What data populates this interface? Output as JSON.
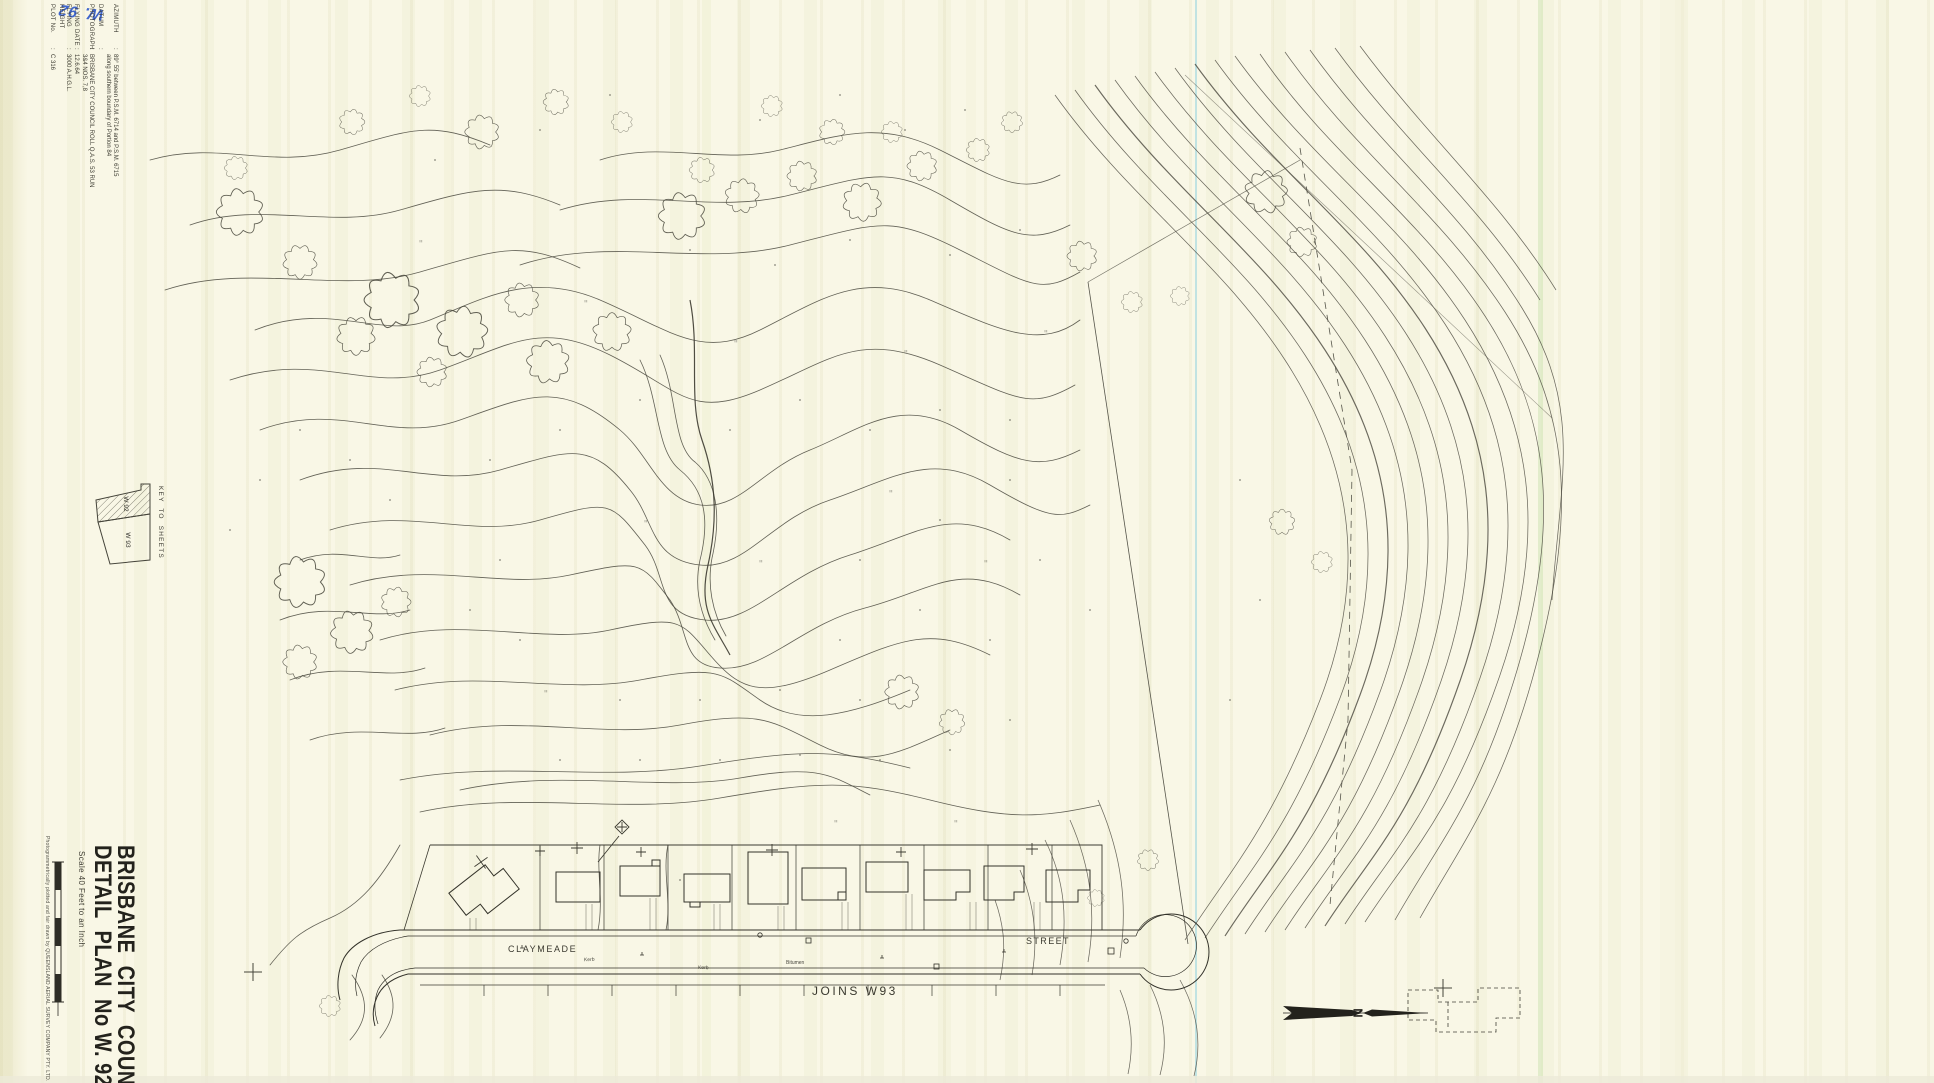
{
  "sheet": {
    "handwritten_note": "W. 92",
    "metadata": {
      "rows": [
        {
          "label": "AZIMUTH",
          "value": "89° 55' between P.S.M. 6714 and P.S.M. 6715 along southern boundary of Portion 84"
        },
        {
          "label": "DATUM",
          "value": ""
        },
        {
          "label": "PHOTOGRAPH",
          "value": "BRISBANE CITY COUNCIL  ROLL Q.A.S. 53 RUN 3&4 NOS. 7,8"
        },
        {
          "label": "FLYING DATE",
          "value": "12.6.64"
        },
        {
          "label": "FLYING HEIGHT",
          "value": "3000  A.H.G.L."
        },
        {
          "label": "PLOT No.",
          "value": "C 316"
        }
      ]
    },
    "key_to_sheets": {
      "label": "KEY  TO  SHEETS",
      "current_sheet": "W 92",
      "adjacent_sheet": "W 93"
    },
    "title_block": {
      "org": "BRISBANE  CITY  COUNCIL",
      "plan": "DETAIL  PLAN  No W. 92",
      "scale": "Scale 40 Feet to an Inch",
      "credit": "Photogrammetrically plotted and fair drawn by  QUEENSLAND AERIAL SURVEY COMPANY PTY. LTD."
    },
    "map": {
      "street_name_left": "CLAYMEADE",
      "street_name_right": "STREET",
      "kerb_label": "Kerb",
      "road_surface_label": "Bitumen",
      "joins_label": "JOINS  W93",
      "north_label": "N"
    },
    "colors": {
      "paper": "#f9f7e6",
      "ink": "#45443a",
      "handwriting_blue": "#3f66cc",
      "scan_line_cyan": "#b7dfe0"
    }
  }
}
